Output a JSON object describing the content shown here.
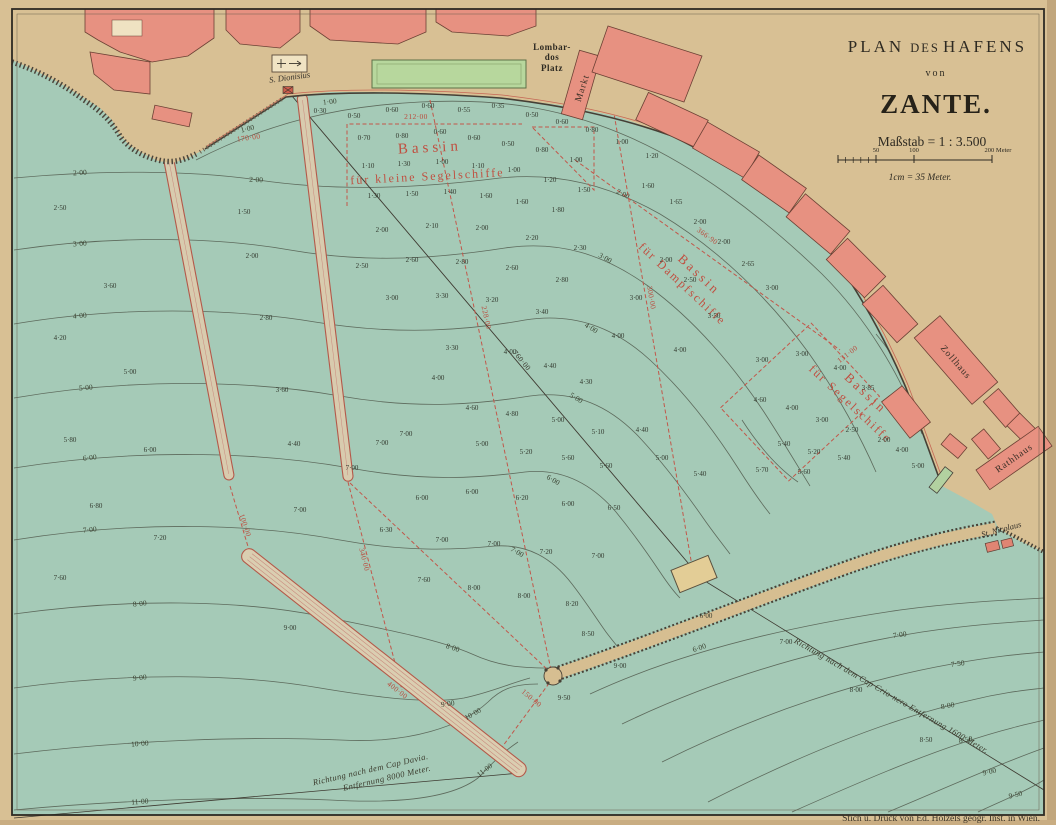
{
  "title_block": {
    "line1_a": "PLAN",
    "line1_b": "DES",
    "line1_c": "HAFENS",
    "line2": "von",
    "line3": "ZANTE.",
    "scale_label": "Maßstab = 1 : 3.500",
    "scale_ticks": {
      "t50": "50",
      "t100": "100",
      "t200": "200 Meter"
    },
    "scale_note": "1cm = 35 Meter."
  },
  "attribution": "Stich u. Druck von Ed. Hölzels geogr. Inst. in Wien.",
  "places": {
    "lombar1": "Lombar-",
    "lombar2": "dos",
    "lombar3": "Platz",
    "markt": "Markt",
    "dionisius": "S. Dionisius",
    "zollhaus": "Zollhaus",
    "rathhaus": "Rathhaus",
    "nicolaus": "St. Nicolaus"
  },
  "basins": {
    "b1_line1": "Bassin",
    "b1_line2": "für kleine Segelschiffe",
    "b2_line1": "Bassin",
    "b2_line2": "für Dampfschiffe",
    "b3_line1": "Bassin",
    "b3_line2": "für Segelschiffe"
  },
  "directions": {
    "crionero": "Richtung nach dem Cap Crio-nero Entfernung 1600 Meter.",
    "davia_line1": "Richtung nach dem Cap Davia.",
    "davia_line2": "Entfernung 8000 Meter."
  },
  "map_data": {
    "colors": {
      "water": "#a5cab7",
      "land": "#d8c094",
      "building": "#e79181",
      "park": "#b7d79d",
      "red_line": "#c2574a",
      "contour": "#5d6a5c",
      "ink": "#2e2a22"
    },
    "dimensions_red": [
      {
        "t": "170·00",
        "x": 249,
        "y": 140,
        "r": -8
      },
      {
        "t": "212·00",
        "x": 416,
        "y": 119,
        "r": 0
      },
      {
        "t": "228·00",
        "x": 484,
        "y": 318,
        "r": 78
      },
      {
        "t": "760·00",
        "x": 520,
        "y": 362,
        "r": 50,
        "k": "blk"
      },
      {
        "t": "100·00",
        "x": 243,
        "y": 526,
        "r": 72
      },
      {
        "t": "340·00",
        "x": 362,
        "y": 560,
        "r": 76
      },
      {
        "t": "400·00",
        "x": 396,
        "y": 692,
        "r": 38
      },
      {
        "t": "150·00",
        "x": 530,
        "y": 700,
        "r": 40
      },
      {
        "t": "366·90",
        "x": 706,
        "y": 238,
        "r": 36
      },
      {
        "t": "300·00",
        "x": 649,
        "y": 298,
        "r": 80
      },
      {
        "t": "131·00",
        "x": 849,
        "y": 356,
        "r": -38
      }
    ],
    "contour_labels": [
      {
        "t": "1·00",
        "x": 248,
        "y": 131,
        "r": -14
      },
      {
        "t": "1·00",
        "x": 330,
        "y": 104,
        "r": -6
      },
      {
        "t": "2·00",
        "x": 80,
        "y": 175,
        "r": -3
      },
      {
        "t": "2·00",
        "x": 256,
        "y": 182,
        "r": 2
      },
      {
        "t": "2·00",
        "x": 622,
        "y": 196,
        "r": 26
      },
      {
        "t": "3·00",
        "x": 80,
        "y": 246,
        "r": -4
      },
      {
        "t": "3·00",
        "x": 604,
        "y": 260,
        "r": 30
      },
      {
        "t": "4·00",
        "x": 80,
        "y": 318,
        "r": -5
      },
      {
        "t": "4·00",
        "x": 590,
        "y": 330,
        "r": 32
      },
      {
        "t": "5·00",
        "x": 86,
        "y": 390,
        "r": -5
      },
      {
        "t": "5·00",
        "x": 575,
        "y": 400,
        "r": 32
      },
      {
        "t": "6·00",
        "x": 90,
        "y": 460,
        "r": -6
      },
      {
        "t": "6·00",
        "x": 552,
        "y": 482,
        "r": 30
      },
      {
        "t": "7·00",
        "x": 90,
        "y": 532,
        "r": -6
      },
      {
        "t": "7·00",
        "x": 516,
        "y": 554,
        "r": 30
      },
      {
        "t": "8·00",
        "x": 140,
        "y": 606,
        "r": -6
      },
      {
        "t": "8·00",
        "x": 452,
        "y": 650,
        "r": 18
      },
      {
        "t": "9·00",
        "x": 140,
        "y": 680,
        "r": -6
      },
      {
        "t": "9·00",
        "x": 448,
        "y": 706,
        "r": -8
      },
      {
        "t": "10·00",
        "x": 140,
        "y": 746,
        "r": -5
      },
      {
        "t": "10·00",
        "x": 474,
        "y": 716,
        "r": -30
      },
      {
        "t": "11·00",
        "x": 140,
        "y": 804,
        "r": -4
      },
      {
        "t": "11·00",
        "x": 486,
        "y": 772,
        "r": -38
      },
      {
        "t": "6·00",
        "x": 700,
        "y": 650,
        "r": -18
      },
      {
        "t": "7·00",
        "x": 900,
        "y": 637,
        "r": -8
      },
      {
        "t": "7·50",
        "x": 958,
        "y": 666,
        "r": -8
      },
      {
        "t": "8·00",
        "x": 948,
        "y": 708,
        "r": -10
      },
      {
        "t": "8·50",
        "x": 966,
        "y": 742,
        "r": -11
      },
      {
        "t": "9·00",
        "x": 990,
        "y": 774,
        "r": -13
      },
      {
        "t": "9·50",
        "x": 1016,
        "y": 797,
        "r": -14
      }
    ],
    "soundings": [
      {
        "t": "0·30",
        "x": 320,
        "y": 113
      },
      {
        "t": "0·50",
        "x": 354,
        "y": 118
      },
      {
        "t": "0·60",
        "x": 392,
        "y": 112
      },
      {
        "t": "0·60",
        "x": 428,
        "y": 108
      },
      {
        "t": "0·55",
        "x": 464,
        "y": 112
      },
      {
        "t": "0·35",
        "x": 498,
        "y": 108
      },
      {
        "t": "0·50",
        "x": 532,
        "y": 117
      },
      {
        "t": "0·60",
        "x": 562,
        "y": 124
      },
      {
        "t": "0·80",
        "x": 592,
        "y": 132
      },
      {
        "t": "1·00",
        "x": 622,
        "y": 144
      },
      {
        "t": "1·20",
        "x": 652,
        "y": 158
      },
      {
        "t": "0·70",
        "x": 364,
        "y": 140
      },
      {
        "t": "0·80",
        "x": 402,
        "y": 138
      },
      {
        "t": "0·60",
        "x": 440,
        "y": 134
      },
      {
        "t": "0·60",
        "x": 474,
        "y": 140
      },
      {
        "t": "0·50",
        "x": 508,
        "y": 146
      },
      {
        "t": "0·80",
        "x": 542,
        "y": 152
      },
      {
        "t": "1·00",
        "x": 576,
        "y": 162
      },
      {
        "t": "1·60",
        "x": 648,
        "y": 188
      },
      {
        "t": "1·65",
        "x": 676,
        "y": 204
      },
      {
        "t": "1·10",
        "x": 368,
        "y": 168
      },
      {
        "t": "1·30",
        "x": 404,
        "y": 166
      },
      {
        "t": "1·00",
        "x": 442,
        "y": 164
      },
      {
        "t": "1·10",
        "x": 478,
        "y": 168
      },
      {
        "t": "1·00",
        "x": 514,
        "y": 172
      },
      {
        "t": "1·20",
        "x": 550,
        "y": 182
      },
      {
        "t": "1·50",
        "x": 584,
        "y": 192
      },
      {
        "t": "2·00",
        "x": 700,
        "y": 224
      },
      {
        "t": "2·00",
        "x": 724,
        "y": 244
      },
      {
        "t": "1·30",
        "x": 374,
        "y": 198
      },
      {
        "t": "1·50",
        "x": 412,
        "y": 196
      },
      {
        "t": "1·40",
        "x": 450,
        "y": 194
      },
      {
        "t": "1·60",
        "x": 486,
        "y": 198
      },
      {
        "t": "1·60",
        "x": 522,
        "y": 204
      },
      {
        "t": "1·80",
        "x": 558,
        "y": 212
      },
      {
        "t": "2·65",
        "x": 748,
        "y": 266
      },
      {
        "t": "3·00",
        "x": 772,
        "y": 290
      },
      {
        "t": "2·00",
        "x": 382,
        "y": 232
      },
      {
        "t": "2·10",
        "x": 432,
        "y": 228
      },
      {
        "t": "2·00",
        "x": 482,
        "y": 230
      },
      {
        "t": "2·20",
        "x": 532,
        "y": 240
      },
      {
        "t": "2·30",
        "x": 580,
        "y": 250
      },
      {
        "t": "2·00",
        "x": 666,
        "y": 262
      },
      {
        "t": "2·50",
        "x": 690,
        "y": 282
      },
      {
        "t": "2·50",
        "x": 362,
        "y": 268
      },
      {
        "t": "2·60",
        "x": 412,
        "y": 262
      },
      {
        "t": "2·80",
        "x": 462,
        "y": 264
      },
      {
        "t": "2·60",
        "x": 512,
        "y": 270
      },
      {
        "t": "2·80",
        "x": 562,
        "y": 282
      },
      {
        "t": "3·00",
        "x": 636,
        "y": 300
      },
      {
        "t": "3·50",
        "x": 714,
        "y": 318
      },
      {
        "t": "3·00",
        "x": 392,
        "y": 300
      },
      {
        "t": "3·30",
        "x": 442,
        "y": 298
      },
      {
        "t": "3·20",
        "x": 492,
        "y": 302
      },
      {
        "t": "3·40",
        "x": 542,
        "y": 314
      },
      {
        "t": "4·00",
        "x": 618,
        "y": 338
      },
      {
        "t": "4·00",
        "x": 680,
        "y": 352
      },
      {
        "t": "1·50",
        "x": 244,
        "y": 214
      },
      {
        "t": "2·00",
        "x": 252,
        "y": 258
      },
      {
        "t": "2·80",
        "x": 266,
        "y": 320
      },
      {
        "t": "3·60",
        "x": 282,
        "y": 392
      },
      {
        "t": "4·40",
        "x": 294,
        "y": 446
      },
      {
        "t": "2·50",
        "x": 60,
        "y": 210
      },
      {
        "t": "3·60",
        "x": 110,
        "y": 288
      },
      {
        "t": "4·20",
        "x": 60,
        "y": 340
      },
      {
        "t": "5·00",
        "x": 130,
        "y": 374
      },
      {
        "t": "5·80",
        "x": 70,
        "y": 442
      },
      {
        "t": "6·00",
        "x": 150,
        "y": 452
      },
      {
        "t": "6·80",
        "x": 96,
        "y": 508
      },
      {
        "t": "7·20",
        "x": 160,
        "y": 540
      },
      {
        "t": "7·60",
        "x": 60,
        "y": 580
      },
      {
        "t": "3·00",
        "x": 762,
        "y": 362
      },
      {
        "t": "3·00",
        "x": 802,
        "y": 356
      },
      {
        "t": "4·00",
        "x": 840,
        "y": 370
      },
      {
        "t": "3·85",
        "x": 868,
        "y": 390
      },
      {
        "t": "4·60",
        "x": 760,
        "y": 402
      },
      {
        "t": "4·00",
        "x": 792,
        "y": 410
      },
      {
        "t": "3·00",
        "x": 822,
        "y": 422
      },
      {
        "t": "2·50",
        "x": 852,
        "y": 432
      },
      {
        "t": "2·00",
        "x": 884,
        "y": 442
      },
      {
        "t": "5·40",
        "x": 784,
        "y": 446
      },
      {
        "t": "5·20",
        "x": 814,
        "y": 454
      },
      {
        "t": "5·40",
        "x": 844,
        "y": 460
      },
      {
        "t": "5·70",
        "x": 762,
        "y": 472
      },
      {
        "t": "5·60",
        "x": 804,
        "y": 474
      },
      {
        "t": "4·00",
        "x": 902,
        "y": 452
      },
      {
        "t": "5·00",
        "x": 918,
        "y": 468
      },
      {
        "t": "3·30",
        "x": 452,
        "y": 350
      },
      {
        "t": "4·00",
        "x": 438,
        "y": 380
      },
      {
        "t": "4·00",
        "x": 510,
        "y": 354
      },
      {
        "t": "4·40",
        "x": 550,
        "y": 368
      },
      {
        "t": "4·30",
        "x": 586,
        "y": 384
      },
      {
        "t": "4·60",
        "x": 472,
        "y": 410
      },
      {
        "t": "4·80",
        "x": 512,
        "y": 416
      },
      {
        "t": "5·00",
        "x": 558,
        "y": 422
      },
      {
        "t": "5·10",
        "x": 598,
        "y": 434
      },
      {
        "t": "5·00",
        "x": 482,
        "y": 446
      },
      {
        "t": "5·20",
        "x": 526,
        "y": 454
      },
      {
        "t": "5·60",
        "x": 568,
        "y": 460
      },
      {
        "t": "5·60",
        "x": 606,
        "y": 468
      },
      {
        "t": "4·40",
        "x": 642,
        "y": 432
      },
      {
        "t": "5·00",
        "x": 662,
        "y": 460
      },
      {
        "t": "5·40",
        "x": 700,
        "y": 476
      },
      {
        "t": "6·00",
        "x": 422,
        "y": 500
      },
      {
        "t": "6·00",
        "x": 472,
        "y": 494
      },
      {
        "t": "6·20",
        "x": 522,
        "y": 500
      },
      {
        "t": "6·00",
        "x": 568,
        "y": 506
      },
      {
        "t": "6·50",
        "x": 614,
        "y": 510
      },
      {
        "t": "6·30",
        "x": 386,
        "y": 532
      },
      {
        "t": "7·00",
        "x": 442,
        "y": 542
      },
      {
        "t": "7·00",
        "x": 494,
        "y": 546
      },
      {
        "t": "7·20",
        "x": 546,
        "y": 554
      },
      {
        "t": "7·00",
        "x": 598,
        "y": 558
      },
      {
        "t": "7·60",
        "x": 424,
        "y": 582
      },
      {
        "t": "8·00",
        "x": 474,
        "y": 590
      },
      {
        "t": "8·00",
        "x": 524,
        "y": 598
      },
      {
        "t": "8·20",
        "x": 572,
        "y": 606
      },
      {
        "t": "7·00",
        "x": 352,
        "y": 470
      },
      {
        "t": "7·00",
        "x": 382,
        "y": 445
      },
      {
        "t": "7·00",
        "x": 406,
        "y": 436
      },
      {
        "t": "7·00",
        "x": 300,
        "y": 512
      },
      {
        "t": "8·50",
        "x": 588,
        "y": 636
      },
      {
        "t": "9·00",
        "x": 620,
        "y": 668
      },
      {
        "t": "9·00",
        "x": 290,
        "y": 630
      },
      {
        "t": "9·50",
        "x": 564,
        "y": 700
      },
      {
        "t": "6·00",
        "x": 706,
        "y": 618
      },
      {
        "t": "7·00",
        "x": 786,
        "y": 644
      },
      {
        "t": "8·00",
        "x": 856,
        "y": 692
      },
      {
        "t": "8·50",
        "x": 926,
        "y": 742
      }
    ]
  }
}
